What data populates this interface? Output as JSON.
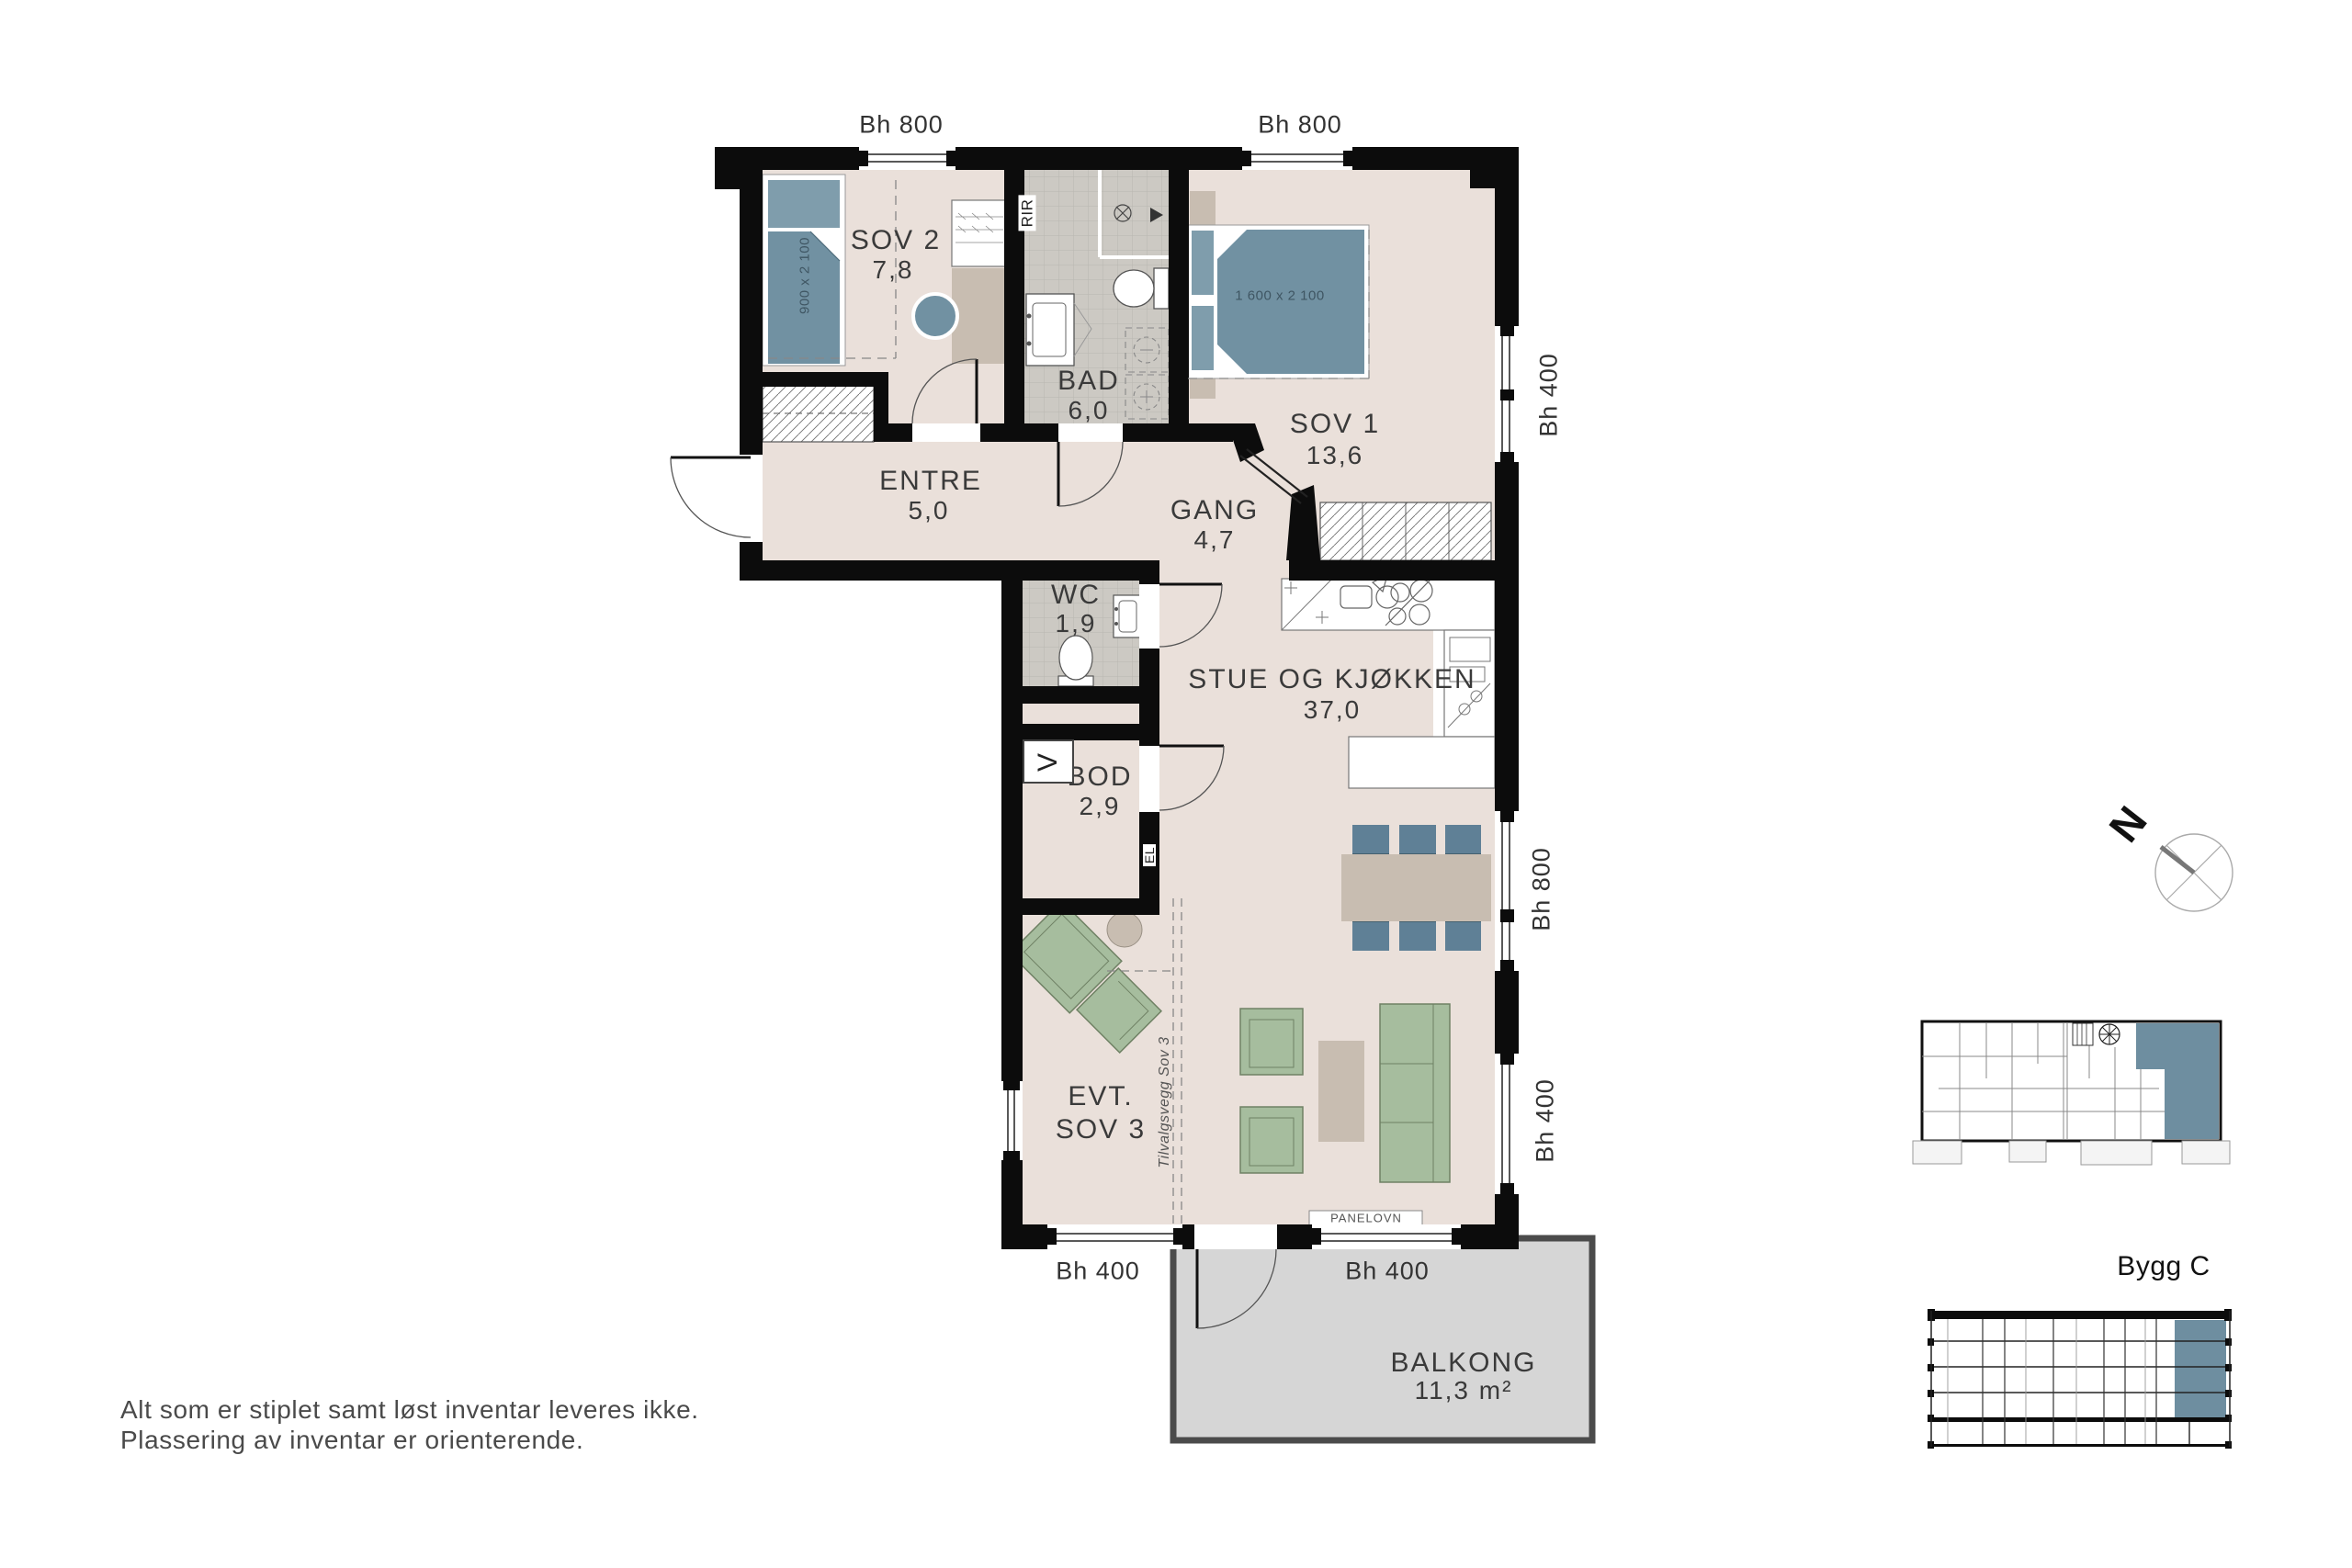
{
  "rooms": {
    "sov2": {
      "name": "SOV 2",
      "area": "7,8"
    },
    "bad": {
      "name": "BAD",
      "area": "6,0"
    },
    "sov1": {
      "name": "SOV 1",
      "area": "13,6"
    },
    "entre": {
      "name": "ENTRE",
      "area": "5,0"
    },
    "gang": {
      "name": "GANG",
      "area": "4,7"
    },
    "wc": {
      "name": "WC",
      "area": "1,9"
    },
    "stue": {
      "name": "STUE OG KJØKKEN",
      "area": "37,0"
    },
    "bod": {
      "name": "BOD",
      "area": "2,9"
    },
    "sov3": {
      "line1": "EVT.",
      "line2": "SOV 3"
    },
    "balkong": {
      "name": "BALKONG",
      "area": "11,3 m²"
    }
  },
  "dimensions": {
    "top_left": "Bh 800",
    "top_right": "Bh 800",
    "right_top": "Bh 400",
    "right_mid": "Bh 800",
    "right_bottom": "Bh 400",
    "bottom_left": "Bh 400",
    "bottom_right": "Bh 400"
  },
  "annotations": {
    "rir": "RIR",
    "el": "EL",
    "vent": "V",
    "panelovn": "PANELOVN",
    "optional_wall": "Tilvalgsvegg Sov 3",
    "bed_small": "900 x 2 100",
    "bed_large": "1 600 x 2 100",
    "north": "N",
    "building": "Bygg C",
    "disclaimer_line1": "Alt som er stiplet samt løst inventar leveres ikke.",
    "disclaimer_line2": "Plassering av inventar er orienterende."
  },
  "colors": {
    "floor": "#eae0da",
    "wall": "#0c0c0c",
    "tile": "#ccc9c3",
    "furniture_blue": "#7191a2",
    "chair_blue": "#5f8096",
    "furniture_green": "#a6bd9e",
    "furniture_beige": "#c8bdb1",
    "balcony": "#d6d6d6",
    "highlight": "#6e8ea0"
  }
}
